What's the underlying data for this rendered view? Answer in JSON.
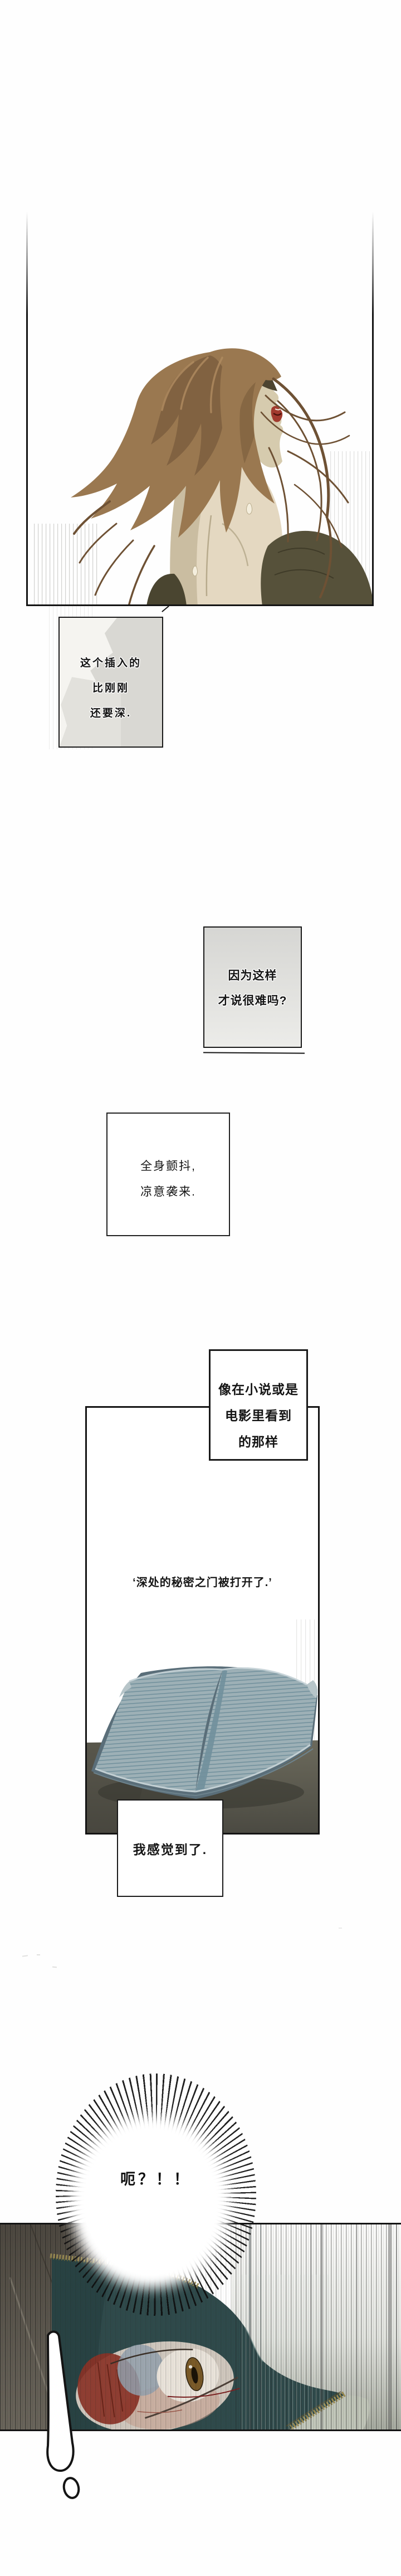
{
  "captions": {
    "box1": {
      "lines": [
        "这个插入的",
        "比刚刚",
        "还要深."
      ]
    },
    "box2": {
      "lines": [
        "因为这样",
        "才说很难吗?"
      ]
    },
    "box3": {
      "lines": [
        "全身颤抖,",
        "凉意袭来."
      ]
    },
    "box4": {
      "lines": [
        "像在小说或是",
        "电影里看到",
        "的那样"
      ]
    },
    "quote": {
      "text": "‘深处的秘密之门被打开了.’"
    },
    "box5": {
      "text": "我感觉到了."
    },
    "burst": {
      "text": "呃？！！"
    }
  },
  "illustrations": {
    "panel1_alt": "woman seen from behind, long brown hair blowing, bare back, red lips, dark top slipping off shoulder",
    "book_alt": "open blue-gray book standing on a dark table",
    "bottom_alt": "sideways close-up of a bloodshot eye under a dark teal hood trimmed with gold lace",
    "burst_alt": "radial speed-line shock burst",
    "exclamation_alt": "white exclamation mark"
  },
  "colors": {
    "ink": "#141414",
    "box-gray": "#d9d8d3",
    "hair-base": "#9a7850",
    "hair-dark": "#6e5134",
    "hair-light": "#b08c60",
    "skin": "#e4d8c1",
    "skin-shadow": "#c3b698",
    "face": "#d6cbae",
    "patch": "#4d4430",
    "lips": "#a23a2e",
    "cloth": "#56513a",
    "cloth-dark": "#4a4530",
    "book-page": "#9db0b6",
    "book-line": "#71909c",
    "book-cover": "#5a6e79",
    "book-edge": "#c8d4d8",
    "table": "#5c5a50",
    "table-dark": "#45443c",
    "teal": "#2f4a4b",
    "teal-dark": "#22393c",
    "lace": "#9b8c52",
    "pale-strip": "#c2c7ba",
    "wall": "#564f44",
    "eye-skin": "#cfc7bd",
    "blood": "#8a3226",
    "iris": "#7a5a28",
    "lid": "#93a0ad"
  }
}
